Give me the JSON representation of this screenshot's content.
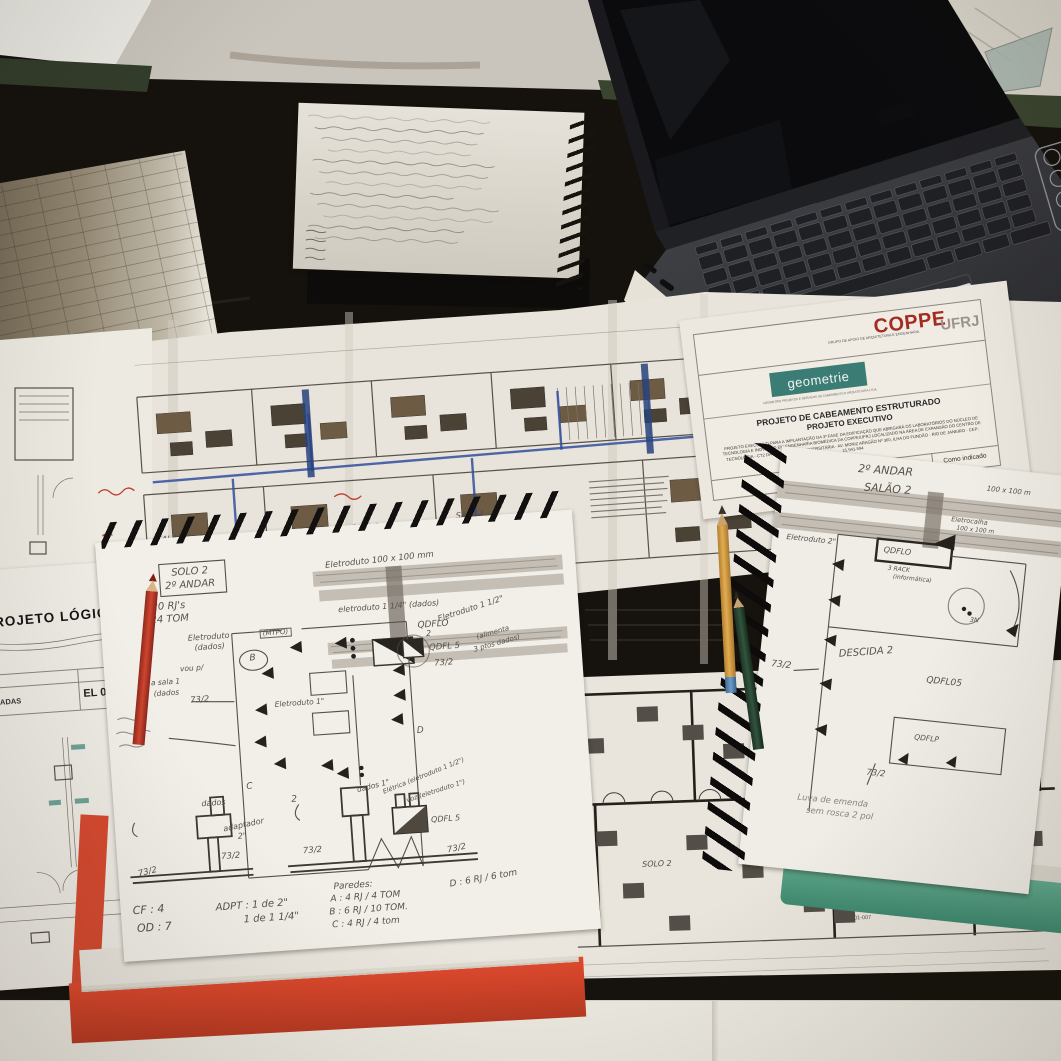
{
  "colors": {
    "table_dark": "#16120d",
    "table_edge_green": "#3a452f",
    "wall_white": "#ecebe5",
    "floor_gray": "#c9c5bd",
    "paper": "#efece5",
    "plan_furniture_olive": "#6d5b44",
    "pen_blue": "#2f4f9e",
    "annotation_red": "#bf3a2b",
    "pencil_graphite": "#56514b",
    "folder_red": "#e04a2e",
    "notebook_cover_green": "#5aa184",
    "brand_red": "#a32c20",
    "logo_teal": "#3b7d74",
    "pencil_yellow": "#d29a41",
    "pencil_green": "#2c4433",
    "laptop_gray": "#3a3b3f"
  },
  "title_block": {
    "brand": "COPPE",
    "university": "UFRJ",
    "brand_caption": "GRUPO DE APOIO DE ARQUITETURA E ENGENHARIA",
    "company_logo": "geometrie",
    "company_caption": "GEOMETRIE PROJETOS E SERVIÇOS DE CABEAMENTO E ARQUITETURA LTDA.",
    "title_line1": "PROJETO DE CABEAMENTO ESTRUTURADO",
    "title_line2": "PROJETO EXECUTIVO",
    "description": "PROJETO EXECUTIVO PARA A IMPLANTAÇÃO DA 3ª FASE DA EDIFICAÇÃO QUE ABRIGARÁ OS LABORATÓRIOS DO NÚCLEO DE TECNOLOGIA E INOVAÇÃO EM ENGENHARIA BIOMÉDICA DA COPPE/UFRJ LOCALIZADO NA ÁREA DE EXPANSÃO DO CENTRO DE TECNOLOGIA - CT2 DA UFRJ, CIDADE UNIVERSITÁRIA - AV. MONIZ ARAGÃO Nº 360, ILHA DO FUNDÃO - RIO DE JANEIRO - CEP: 21.941-594",
    "date": "OUTUBRO/2019",
    "scale": "Como indicado"
  },
  "left_sheet": {
    "title": "PROJETO LÓGICO",
    "sheet_number": "EL 04.",
    "row_label": "MADAS",
    "note_line1": "CONFERIR O",
    "note_line2": "NO LOCAL DE"
  },
  "big_plan": {
    "rooms": [
      "SALA 1",
      "SALA 2",
      "SALA 3",
      "SALA 4",
      "SALA 5"
    ]
  },
  "bottom_plan": {
    "room_left": "SOLO 2",
    "room_right": "SOLO 3",
    "panel": "QDFL - N",
    "camera_label": "CFTV-R01-007"
  },
  "sketchpad": {
    "box1": "SOLO 2",
    "box2": "2º ANDAR",
    "rj": "20 RJ's",
    "tom": "24 TOM",
    "duct_top": "Eletroduto 100 x 100 mm",
    "duct_quarter": "eletroduto 1 1/4\" (dados)",
    "qdflo": "QDFLO",
    "duct_left": "Eletroduto",
    "duct_left2": "(dados)",
    "mtpo": "(MTPO)",
    "b": "B",
    "note_go1": "vou p/",
    "note_go2": "a sala 1",
    "note_go3": "(dados",
    "s737_left": "73/2",
    "duct_one": "Eletroduto 1\"",
    "duct_half": "Eletroduto 1 1/2\"",
    "two": "2",
    "feeds1": "(alimenta",
    "feeds2": "3 ptos dados)",
    "qdfl5": "QDFL 5",
    "s737_right": "73/2",
    "d": "D",
    "c": "C",
    "det1_dados": "dados",
    "det1_adapt": "adaptador",
    "det1_adapt2": "2\"",
    "det1_737a": "73/2",
    "det1_737b": "73/2",
    "det2_num": "2",
    "det2_dados": "dados 1\"",
    "det2_elec": "Elétrica (eletroduto 1 1/2\")",
    "det2_voz": "voz (eletroduto 1\")",
    "det2_qdfl5": "QDFL 5",
    "det2_737a": "73/2",
    "det2_737b": "73/2",
    "cf": "CF : 4",
    "od": "OD : 7",
    "adpt": "ADPT : 1 de 2\"",
    "adpt2": "1 de 1 1/4\"",
    "paredes": "Paredes:",
    "pa": "A : 4 RJ / 4 TOM",
    "pb": "B : 6 RJ / 10 TOM.",
    "pc": "C : 4 RJ / 4 tom",
    "pd": "D : 6 RJ / 6 tom"
  },
  "right_notebook": {
    "h1": "2º ANDAR",
    "h2": "SALÃO 2",
    "dim": "100 x 100 m",
    "calha": "Eletrocalha",
    "calha2": "100 x 100 m",
    "duct2": "Eletroduto 2\"",
    "qdflo": "QDFLO",
    "rack1": "3 RACK",
    "rack2": "(informática)",
    "descida": "DESCIDA 2",
    "qdfl05": "QDFL05",
    "s737": "73/2",
    "n3": "3N",
    "qdflp": "QDFLP",
    "s737b": "73/2",
    "luva1": "Luva de emenda",
    "luva2": "sem rosca 2 pol"
  }
}
